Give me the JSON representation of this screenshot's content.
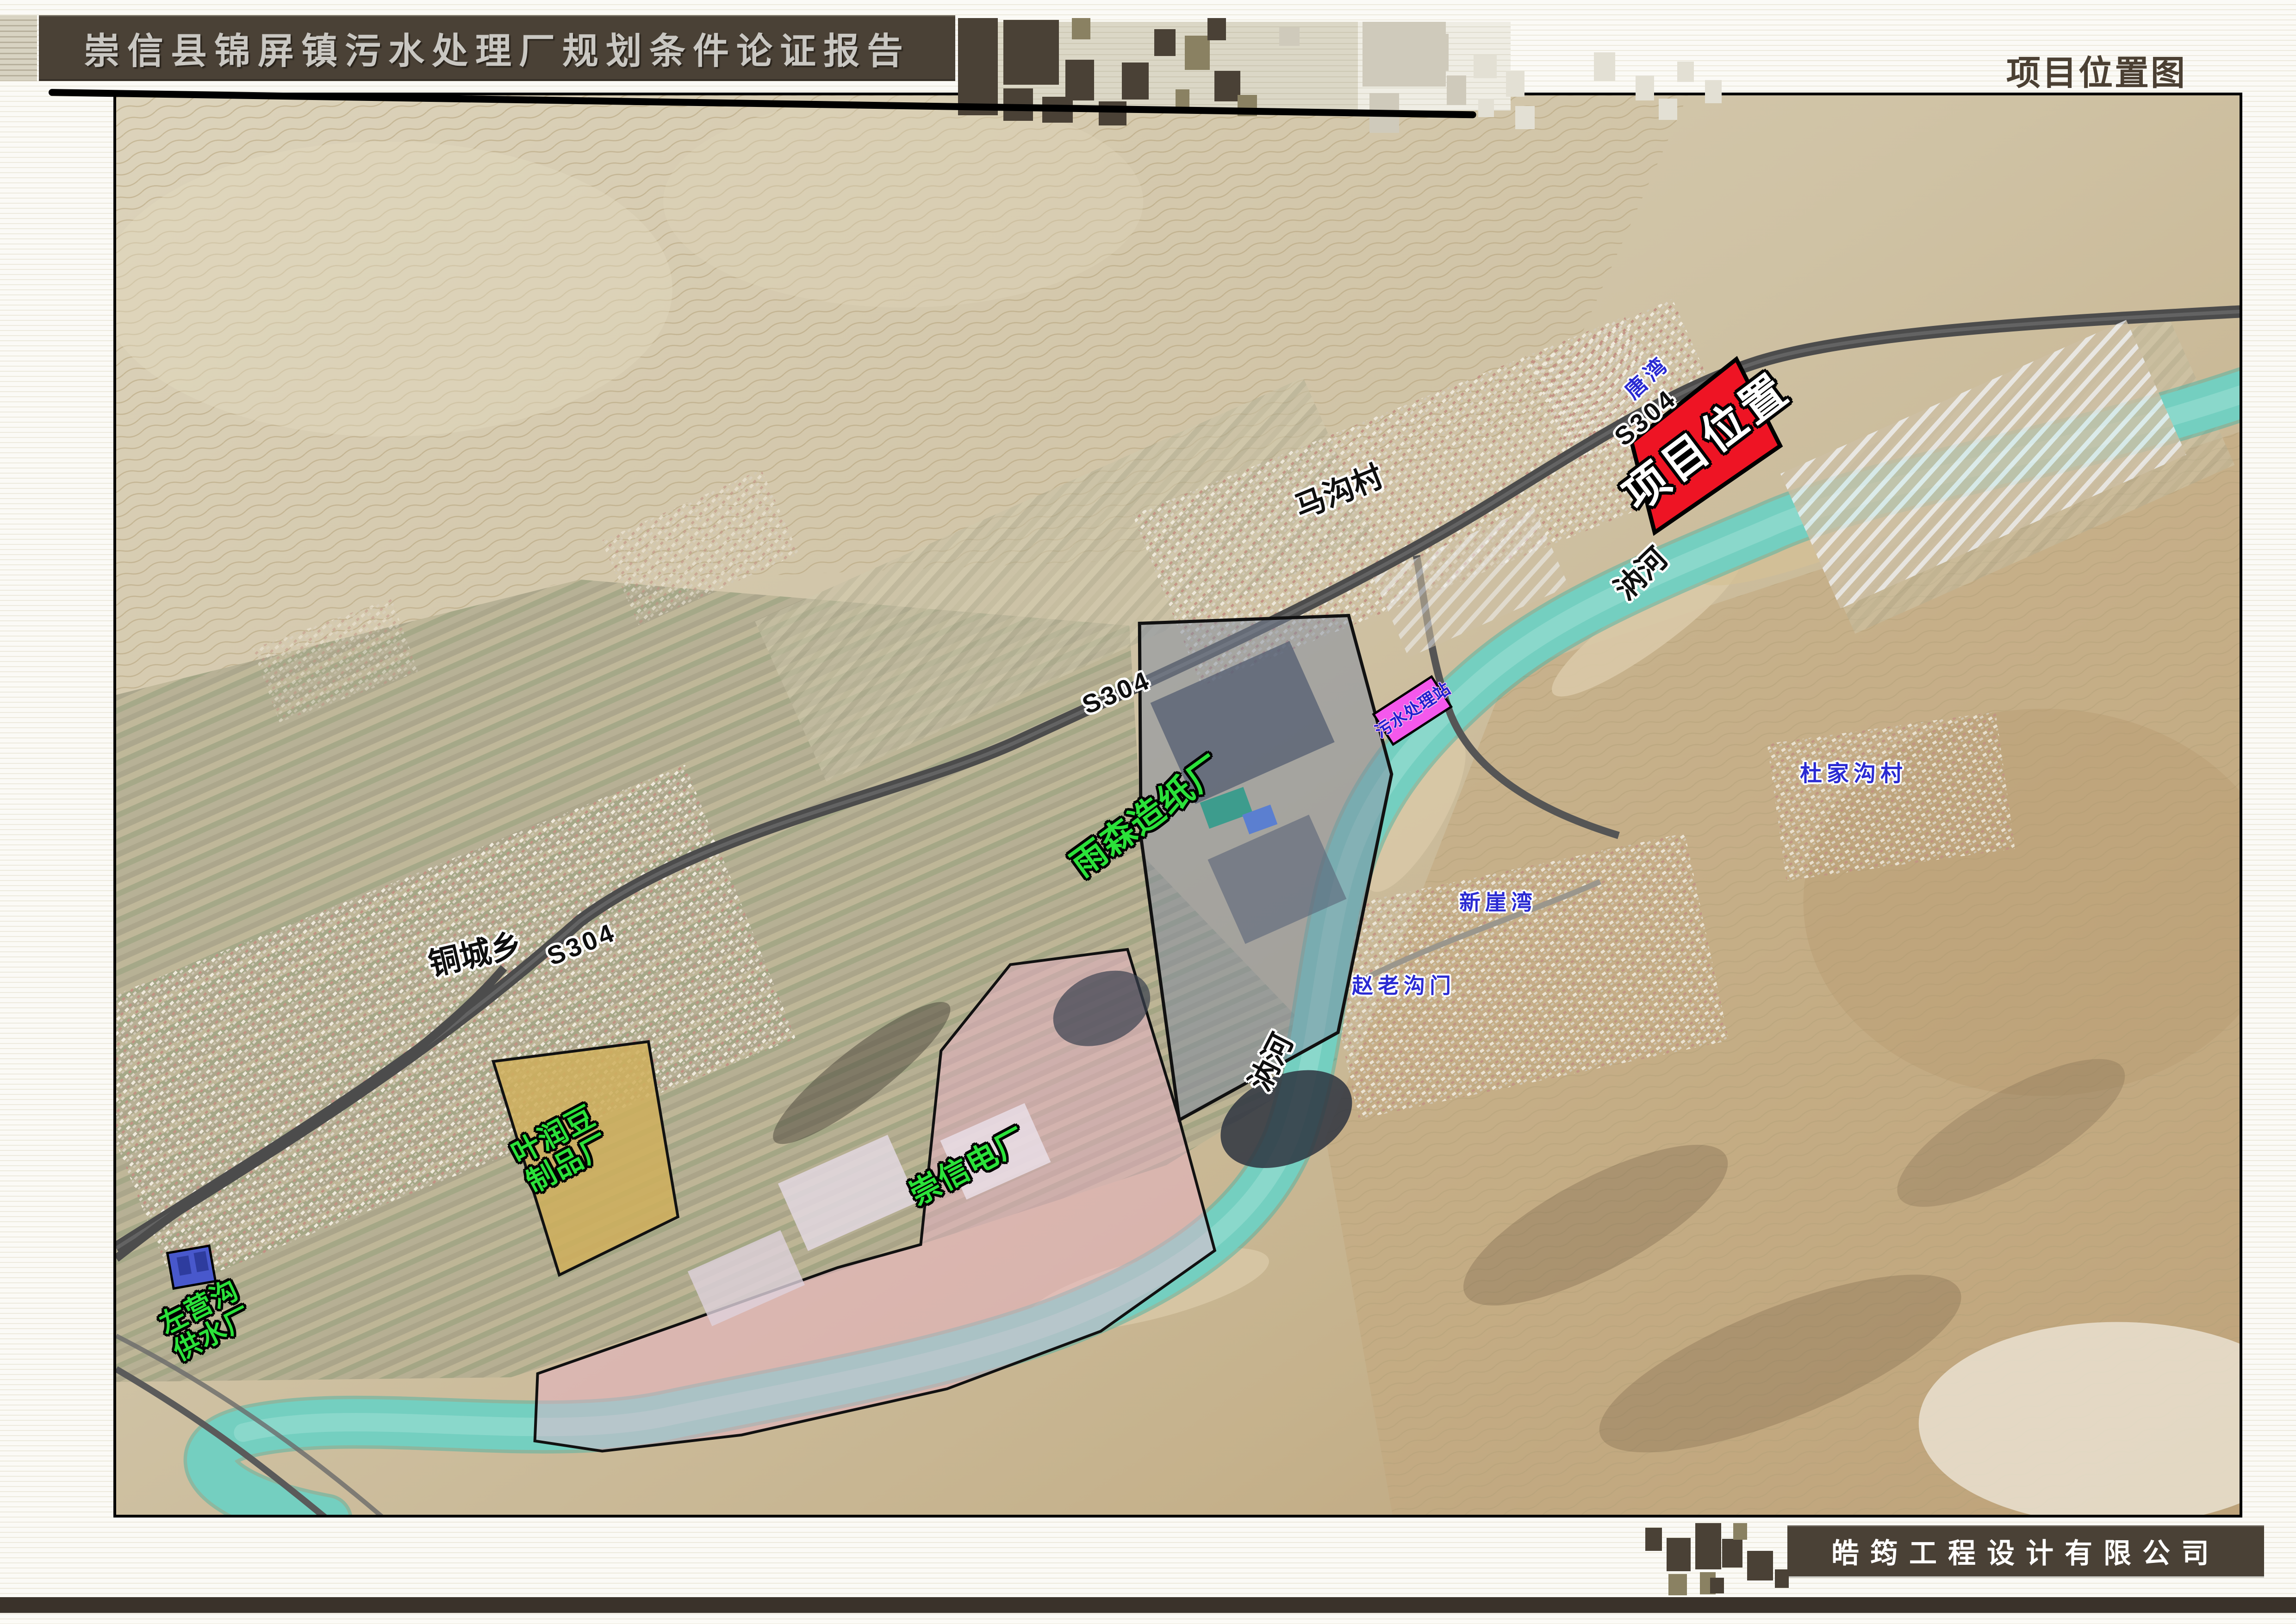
{
  "header": {
    "report_title": "崇信县锦屏镇污水处理厂规划条件论证报告",
    "page_title": "项目位置图"
  },
  "footer": {
    "company_name": "皓筠工程设计有限公司"
  },
  "colors": {
    "header_bar": "#4a4136",
    "project_area": "#ee1424",
    "paper_mill_overlay": "#7d8aa0",
    "power_plant_overlay": "#eeb2cd",
    "bean_factory_overlay": "#cfaf5c",
    "waterworks_parcel": "#4858cc",
    "sewage_station_parcel": "#f458ec",
    "river": "#74cfc0",
    "road": "#4c4c4c",
    "label_green": "#2be23a",
    "label_blue": "#2a2ad2"
  },
  "map": {
    "labels": [
      {
        "id": "project-location",
        "text": "项目位置",
        "category": "project-area"
      },
      {
        "id": "tangwan",
        "text": "唐湾",
        "category": "village"
      },
      {
        "id": "s304-north",
        "text": "S304",
        "category": "road"
      },
      {
        "id": "s304-middle",
        "text": "S304",
        "category": "road"
      },
      {
        "id": "s304-west",
        "text": "S304",
        "category": "road"
      },
      {
        "id": "magou-village",
        "text": "马沟村",
        "category": "village"
      },
      {
        "id": "rui-river-north",
        "text": "汭河",
        "category": "river"
      },
      {
        "id": "rui-river-middle",
        "text": "汭河",
        "category": "river"
      },
      {
        "id": "yusen-paper-mill",
        "text": "雨森造纸厂",
        "category": "factory"
      },
      {
        "id": "sewage-station",
        "text": "污水处理站",
        "category": "facility"
      },
      {
        "id": "dujiagou-village",
        "text": "杜家沟村",
        "category": "village"
      },
      {
        "id": "xinyawan",
        "text": "新崖湾",
        "category": "village"
      },
      {
        "id": "zhaolaogoumen",
        "text": "赵老沟门",
        "category": "village"
      },
      {
        "id": "tongcheng-township",
        "text": "铜城乡",
        "category": "village"
      },
      {
        "id": "yerun-bean-factory",
        "text": "叶润豆\n制品厂",
        "category": "factory"
      },
      {
        "id": "chongxin-power-plant",
        "text": "崇信电厂",
        "category": "factory"
      },
      {
        "id": "zuoyinggou-waterworks",
        "text": "左营沟\n供水厂",
        "category": "factory"
      }
    ]
  }
}
